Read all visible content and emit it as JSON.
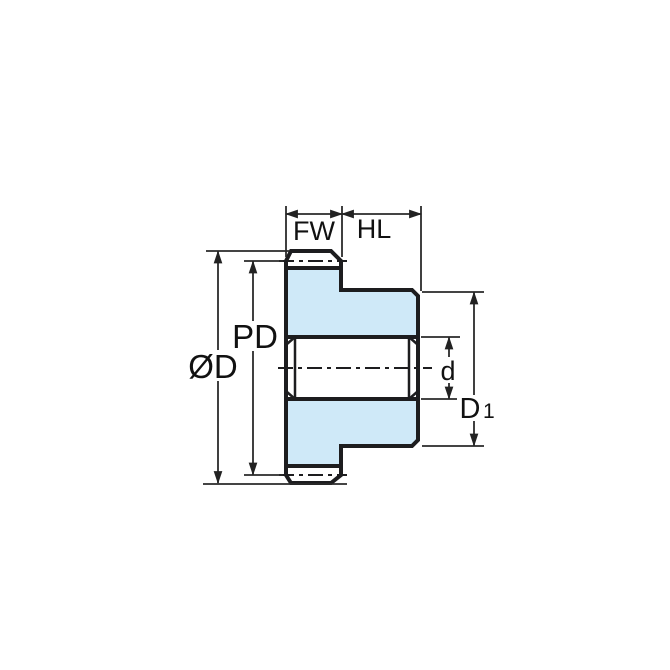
{
  "diagram": {
    "type": "engineering-drawing",
    "subject": "spur gear side cross-section with dimension callouts",
    "labels": {
      "face_width": "FW",
      "hub_length": "HL",
      "pitch_diameter": "PD",
      "outside_diameter": "ØD",
      "bore_diameter": "d",
      "hub_diameter_main": "D",
      "hub_diameter_sub": "1"
    },
    "colors": {
      "gear_fill": "#cfe9f8",
      "outline": "#1d1d1f",
      "dimension_line": "#2a2a2a",
      "background": "#ffffff"
    }
  }
}
